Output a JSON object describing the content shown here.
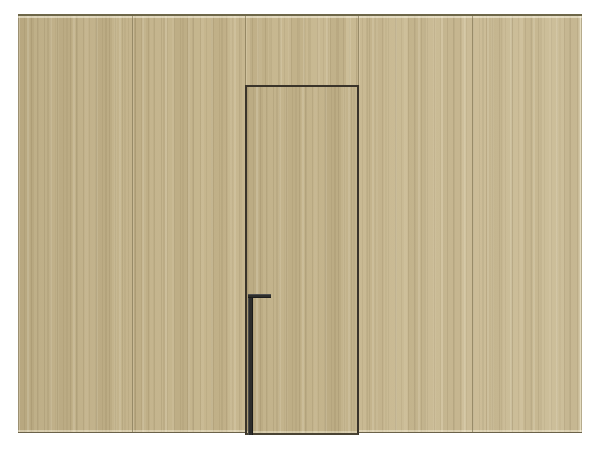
{
  "scene": {
    "title": "Concealed flush door in light-oak wood panel wall",
    "type": "3d-product-render",
    "aria_label": "Rendered wall of five vertical light-oak wood panels with a concealed flush door in the center and a black L-shaped edge handle"
  },
  "wall": {
    "panel_count": 5,
    "material": "light oak veneer, vertical grain",
    "full_seam_count": 2,
    "jamb_seam_count": 2
  },
  "door": {
    "style": "concealed flush door, frameless, wood-matched",
    "outline_color": "#3a342a",
    "handle": {
      "style": "L-shaped vertical edge pull, floor to mid-height",
      "color": "#2d2d2b"
    }
  },
  "colors": {
    "background": "#ffffff",
    "wood_base": "#c5b58d",
    "wood_highlight": "#d6c9a3",
    "wood_shadow": "#a3946b",
    "panel_seam": "#7d7150",
    "door_outline": "#3a342a",
    "handle": "#2d2d2b",
    "wall_top_edge": "#6e6749",
    "wall_bottom_edge": "#6b6249"
  }
}
